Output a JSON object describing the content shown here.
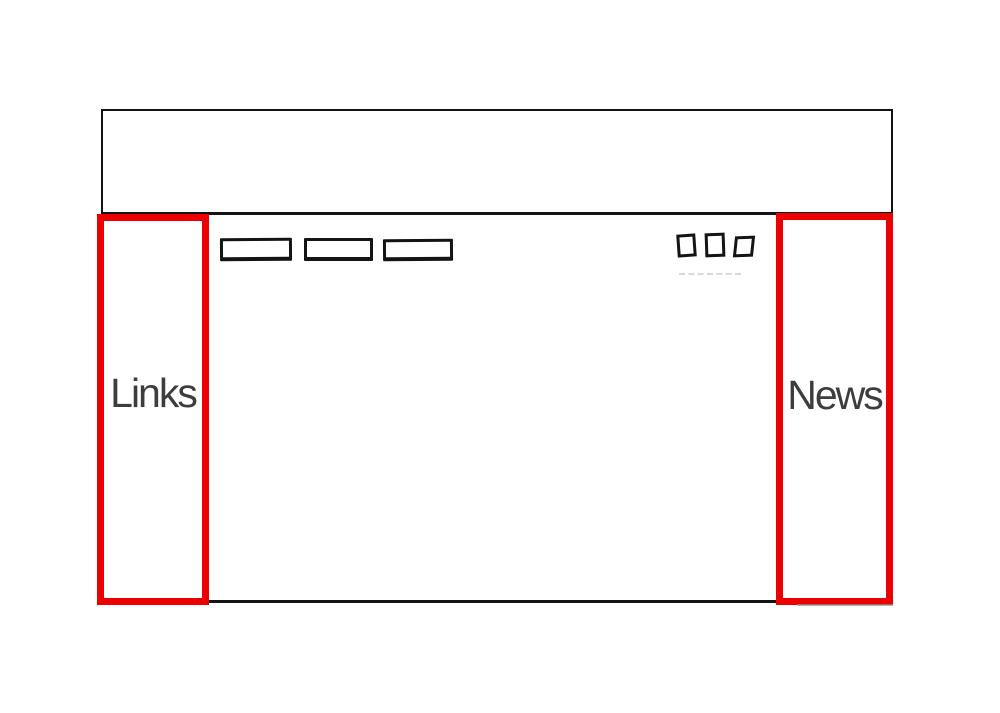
{
  "wireframe": {
    "left_annotation": {
      "label": "Links"
    },
    "right_annotation": {
      "label": "News"
    },
    "nav_button_placeholders": 3,
    "control_square_icons": 3
  },
  "colors": {
    "annotation_red": "#ec0000",
    "sketch_ink": "#141414",
    "label_text": "#3d3d3d",
    "canvas_bg": "#ffffff"
  }
}
